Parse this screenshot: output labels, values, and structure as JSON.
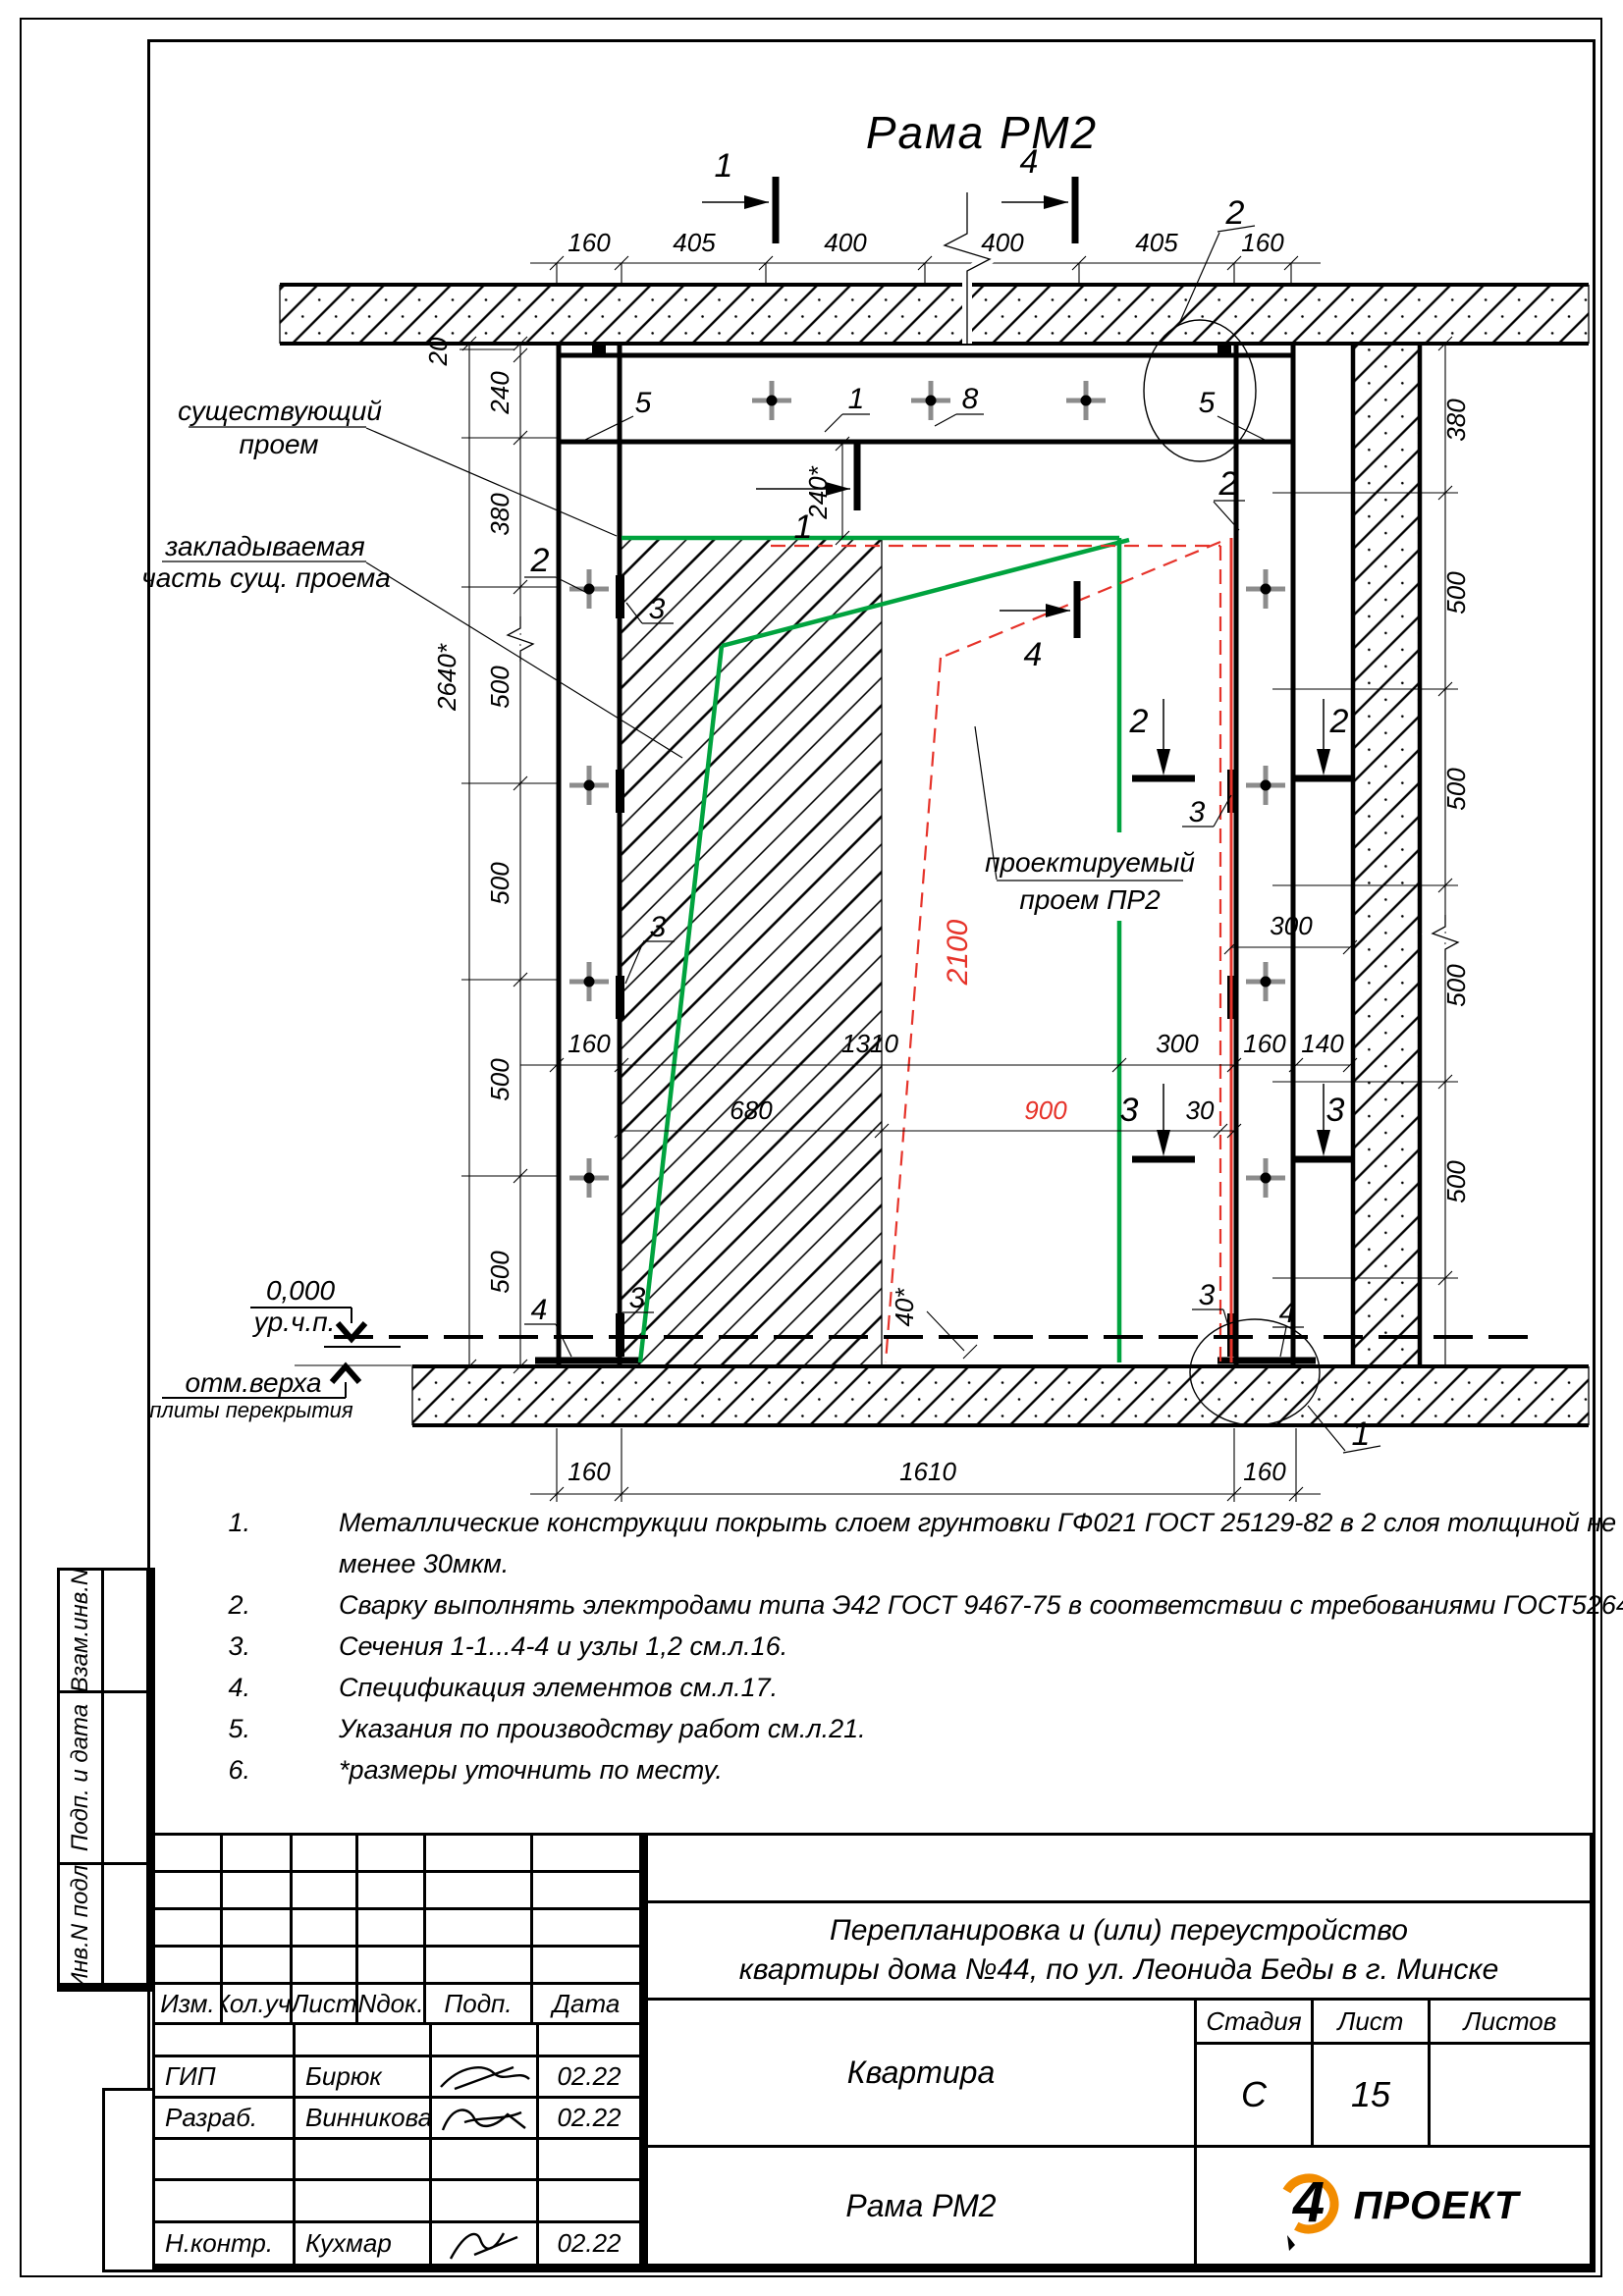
{
  "title": "Рама РМ2",
  "sym": {
    "s1": "1",
    "s2": "2",
    "s3": "3",
    "s4": "4",
    "s5": "5",
    "s8": "8"
  },
  "labels": {
    "existing": [
      "существующий",
      "проем"
    ],
    "infill": [
      "закладываемая",
      "часть сущ. проема"
    ],
    "designed": [
      "проектируемый",
      "проем ПР2"
    ],
    "lvl0": "0,000",
    "lvl0s": "ур.ч.п.",
    "lvlTop": "отм.верха",
    "lvlTops": "плиты перекрытия"
  },
  "dims": {
    "top": [
      "160",
      "405",
      "400",
      "400",
      "405",
      "160"
    ],
    "left": [
      "20",
      "240",
      "380",
      "500",
      "500",
      "500",
      "500"
    ],
    "leftTotal": "2640*",
    "right": [
      "380",
      "500",
      "500",
      "500",
      "500"
    ],
    "row1": [
      "160",
      "1310",
      "300",
      "160",
      "140"
    ],
    "row2": [
      "680",
      "900",
      "30"
    ],
    "r300": "300",
    "h240": "240*",
    "red2100": "2100",
    "gap40": "40*",
    "bottom": [
      "160",
      "1610",
      "160"
    ]
  },
  "notes": [
    {
      "n": "1.",
      "t": "Металлические конструкции покрыть слоем грунтовки ГФ021 ГОСТ 25129-82 в 2 слоя толщиной не"
    },
    {
      "n": "",
      "t": "менее 30мкм."
    },
    {
      "n": "2.",
      "t": "Сварку выполнять электродами типа Э42 ГОСТ 9467-75 в соответствии с требованиями ГОСТ5264-80."
    },
    {
      "n": "3.",
      "t": "Сечения 1-1...4-4 и узлы 1,2 см.л.16."
    },
    {
      "n": "4.",
      "t": "Спецификация элементов см.л.17."
    },
    {
      "n": "5.",
      "t": "Указания по производству работ см.л.21."
    },
    {
      "n": "6.",
      "t": "*размеры уточнить по месту."
    }
  ],
  "sidebar": [
    "Взам.инв.N",
    "Подп. и дата",
    "Инв.N подл."
  ],
  "tb": {
    "cols": [
      "Изм.",
      "Кол.уч.",
      "Лист",
      "Nдок.",
      "Подп.",
      "Дата"
    ],
    "rows": [
      {
        "role": "ГИП",
        "name": "Бирюк",
        "date": "02.22"
      },
      {
        "role": "Разраб.",
        "name": "Винникова",
        "date": "02.22"
      },
      {
        "role": "",
        "name": "",
        "date": ""
      },
      {
        "role": "",
        "name": "",
        "date": ""
      },
      {
        "role": "Н.контр.",
        "name": "Кухмар",
        "date": "02.22"
      }
    ],
    "project": [
      "Перепланировка и (или) переустройство",
      "квартиры дома №44, по ул. Леонида Беды в г. Минске"
    ],
    "object": "Квартира",
    "doc": "Рама РМ2",
    "stage_l": "Стадия",
    "sheet_l": "Лист",
    "sheets_l": "Листов",
    "stage": "С",
    "sheet": "15",
    "sheets": "",
    "logo4": "4",
    "logoTxt": "ПРОЕКТ"
  },
  "colors": {
    "green": "#00A33E",
    "red": "#E6332A",
    "orange": "#F28C00",
    "gray": "#8C8C8C"
  }
}
